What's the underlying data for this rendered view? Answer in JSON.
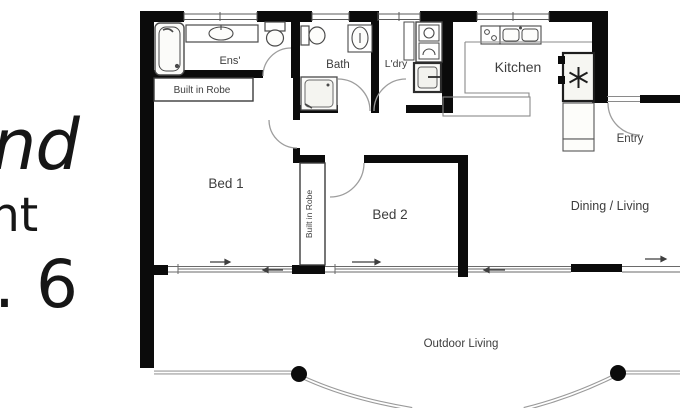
{
  "page": {
    "background": "#ffffff"
  },
  "left_text": {
    "fragment_1": "nd",
    "fragment_2": "nt",
    "fragment_3": ". 6"
  },
  "floorplan": {
    "labels": {
      "ensuite": "Ens'",
      "built_in_robe_1": "Built in Robe",
      "bed1": "Bed 1",
      "bath": "Bath",
      "laundry": "L'dry",
      "kitchen": "Kitchen",
      "entry": "Entry",
      "built_in_robe_2": "Built in Robe",
      "bed2": "Bed 2",
      "dining_living": "Dining / Living",
      "outdoor_living": "Outdoor Living"
    },
    "icons": [
      "bathtub-icon",
      "vanity-basin-icon",
      "toilet-icon",
      "shower-icon",
      "washer-icon",
      "dryer-icon",
      "laundry-tub-icon",
      "cooktop-icon",
      "double-sink-icon",
      "fridge-star-icon",
      "door-swing-arc",
      "window-glazing",
      "sliding-door-arrow",
      "balcony-post-dot"
    ],
    "colors": {
      "wall": "#0b0b0b",
      "thin_line": "#8a8a8a",
      "fixture_line": "#4a4a4a",
      "label_text": "#3d3d3d",
      "side_text": "#161616"
    }
  }
}
